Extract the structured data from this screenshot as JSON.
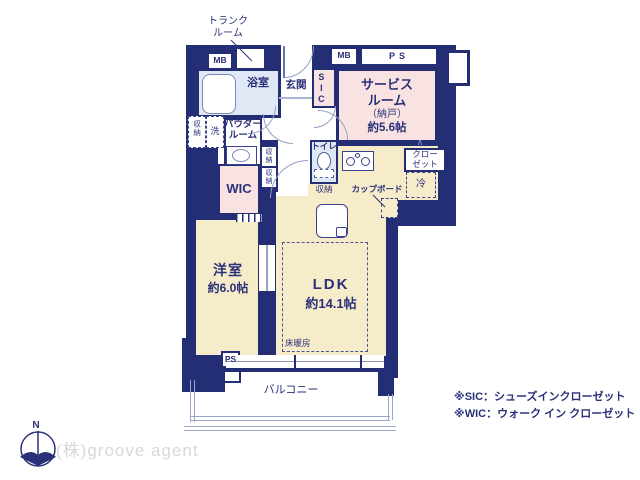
{
  "rooms": {
    "trunk_line1": "トランク",
    "trunk_line2": "ルーム",
    "bath": "浴室",
    "entrance": "玄関",
    "sic": "SIC",
    "service_line1": "サービス",
    "service_line2": "ルーム",
    "service_line3": "（納戸）",
    "service_line4": "約5.6帖",
    "powder_line1": "パウダー",
    "powder_line2": "ルーム",
    "toilet": "トイレ",
    "wic": "WIC",
    "western_line1": "洋室",
    "western_line2": "約6.0帖",
    "ldk_line1": "LDK",
    "ldk_line2": "約14.1帖",
    "floor_heating": "床暖房",
    "balcony": "バルコニー"
  },
  "fixtures": {
    "mb": "MB",
    "ps": "PS",
    "storage": "収納",
    "washer": "洗",
    "closet_line1": "クロー",
    "closet_line2": "ゼット",
    "cupboard": "カップボード",
    "fridge": "冷"
  },
  "legend": {
    "note_sic": "※SIC：シューズインクローゼット",
    "note_wic": "※WIC：ウォーク イン クローゼット"
  },
  "footer": {
    "company": "(株)groove agent",
    "compass_n": "N"
  },
  "colors": {
    "wall": "#242e74",
    "room_pink": "#f9e3e2",
    "room_beige": "#f6ecca",
    "room_blue": "#dfe8f4",
    "text": "#2b3178"
  }
}
